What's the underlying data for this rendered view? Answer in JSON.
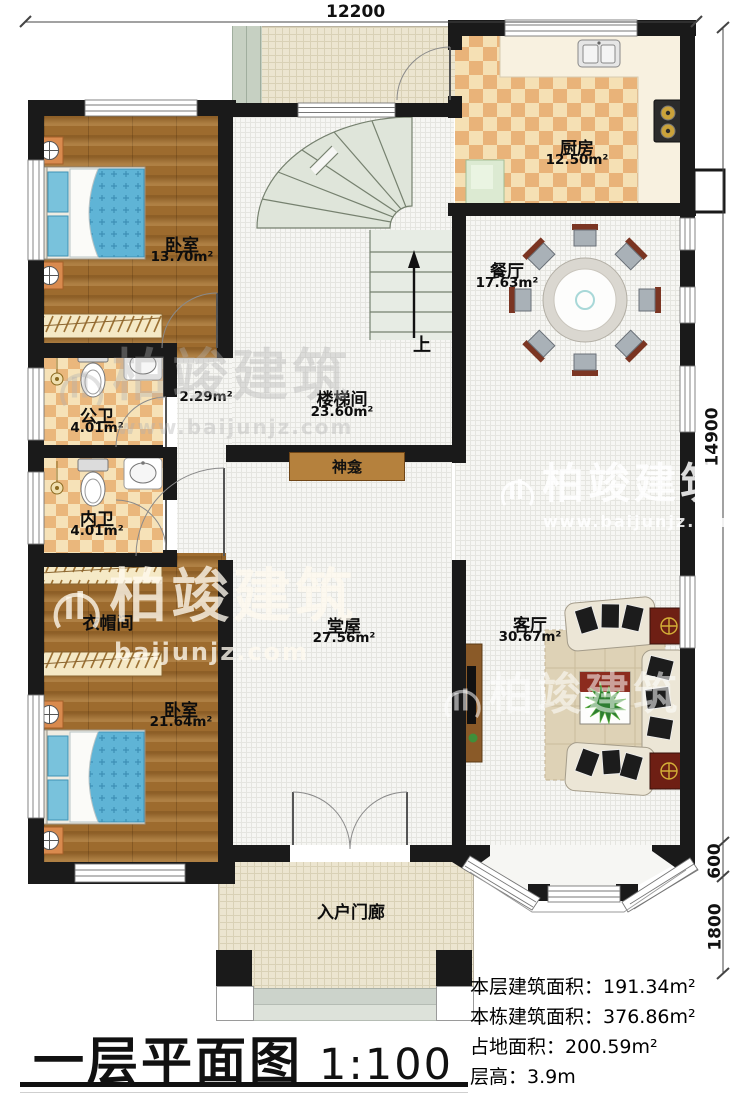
{
  "meta": {
    "title": "一层平面图",
    "scale": "1:100"
  },
  "dimensions": {
    "top": "12200",
    "right_main": "14900",
    "right_mid": "600",
    "right_low": "1800"
  },
  "rooms": {
    "bedroom1": {
      "name": "卧室",
      "area": "13.70m²"
    },
    "kitchen": {
      "name": "厨房",
      "area": "12.50m²"
    },
    "dining": {
      "name": "餐厅",
      "area": "17.63m²"
    },
    "stairwell": {
      "name": "楼梯间",
      "area": "23.60m²"
    },
    "corridor": {
      "area": "2.29m²"
    },
    "public_bath": {
      "name": "公卫",
      "area": "4.01m²"
    },
    "private_bath": {
      "name": "内卫",
      "area": "4.01m²"
    },
    "cloakroom": {
      "name": "衣帽间"
    },
    "bedroom2": {
      "name": "卧室",
      "area": "21.64m²"
    },
    "hall": {
      "name": "堂屋",
      "area": "27.56m²"
    },
    "living": {
      "name": "客厅",
      "area": "30.67m²"
    },
    "porch": {
      "name": "入户门廊"
    },
    "shrine": {
      "name": "神龛"
    },
    "stairs_up": {
      "label": "上"
    }
  },
  "stats": {
    "rows": [
      {
        "label": "本层建筑面积：",
        "value": "191.34m²"
      },
      {
        "label": "本栋建筑面积：",
        "value": "376.86m²"
      },
      {
        "label": "占地面积：",
        "value": "200.59m²"
      },
      {
        "label": "层高：",
        "value": "3.9m"
      }
    ]
  },
  "watermark": {
    "brand": "柏竣建筑",
    "url": "www.baijunjz.com",
    "url_short": "baijunjz.com"
  },
  "colors": {
    "wall": "#1a1a1a",
    "wood_floor": "#9d6b2e",
    "tile_orange": "#e9b379",
    "tile_cream": "#f5e0b4",
    "bed_blue": "#5fb4d6",
    "shelf_brown": "#b5813d",
    "table_red": "#7a2f1f"
  }
}
